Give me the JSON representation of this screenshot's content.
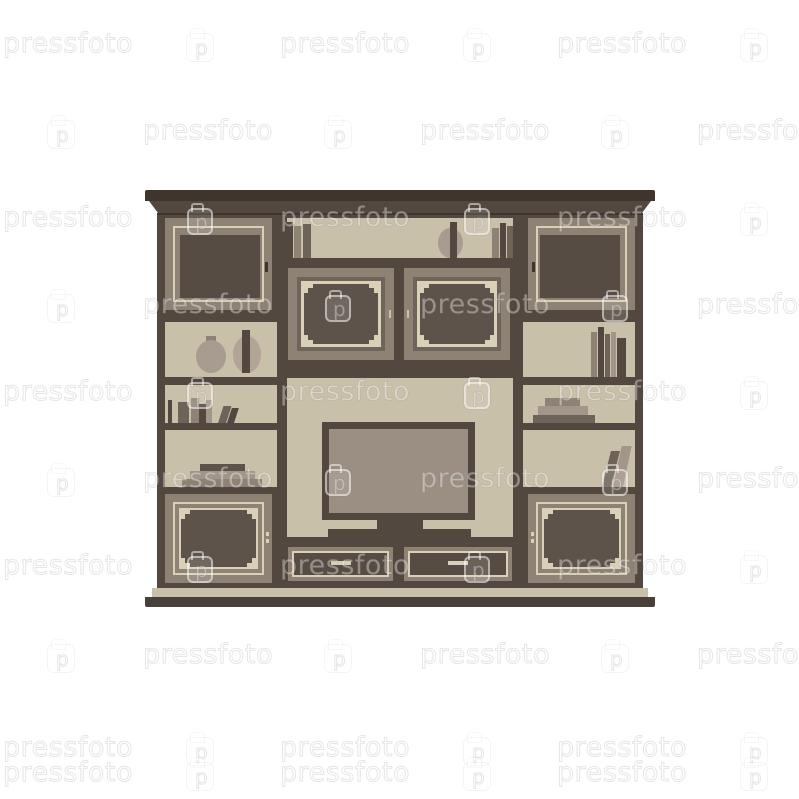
{
  "watermark": {
    "text": "pressfoto",
    "logo_letter": "p"
  },
  "palette": {
    "bg": "#ffffff",
    "cornice_dark": "#3e362e",
    "frame_dark": "#52483f",
    "base_dark": "#4a403a",
    "panel_light": "#c9c0a9",
    "frame_taupe": "#8e8275",
    "cream": "#d9d1b7",
    "window_dark": "#564c44",
    "panel_dark": "#5d534a",
    "step_dark": "#6e645a",
    "tv_screen": "#9b8f84",
    "book_dark": "#6e6359",
    "book_light": "#a2958a",
    "vase": "#a89b90",
    "vase_light": "#b2a597"
  }
}
